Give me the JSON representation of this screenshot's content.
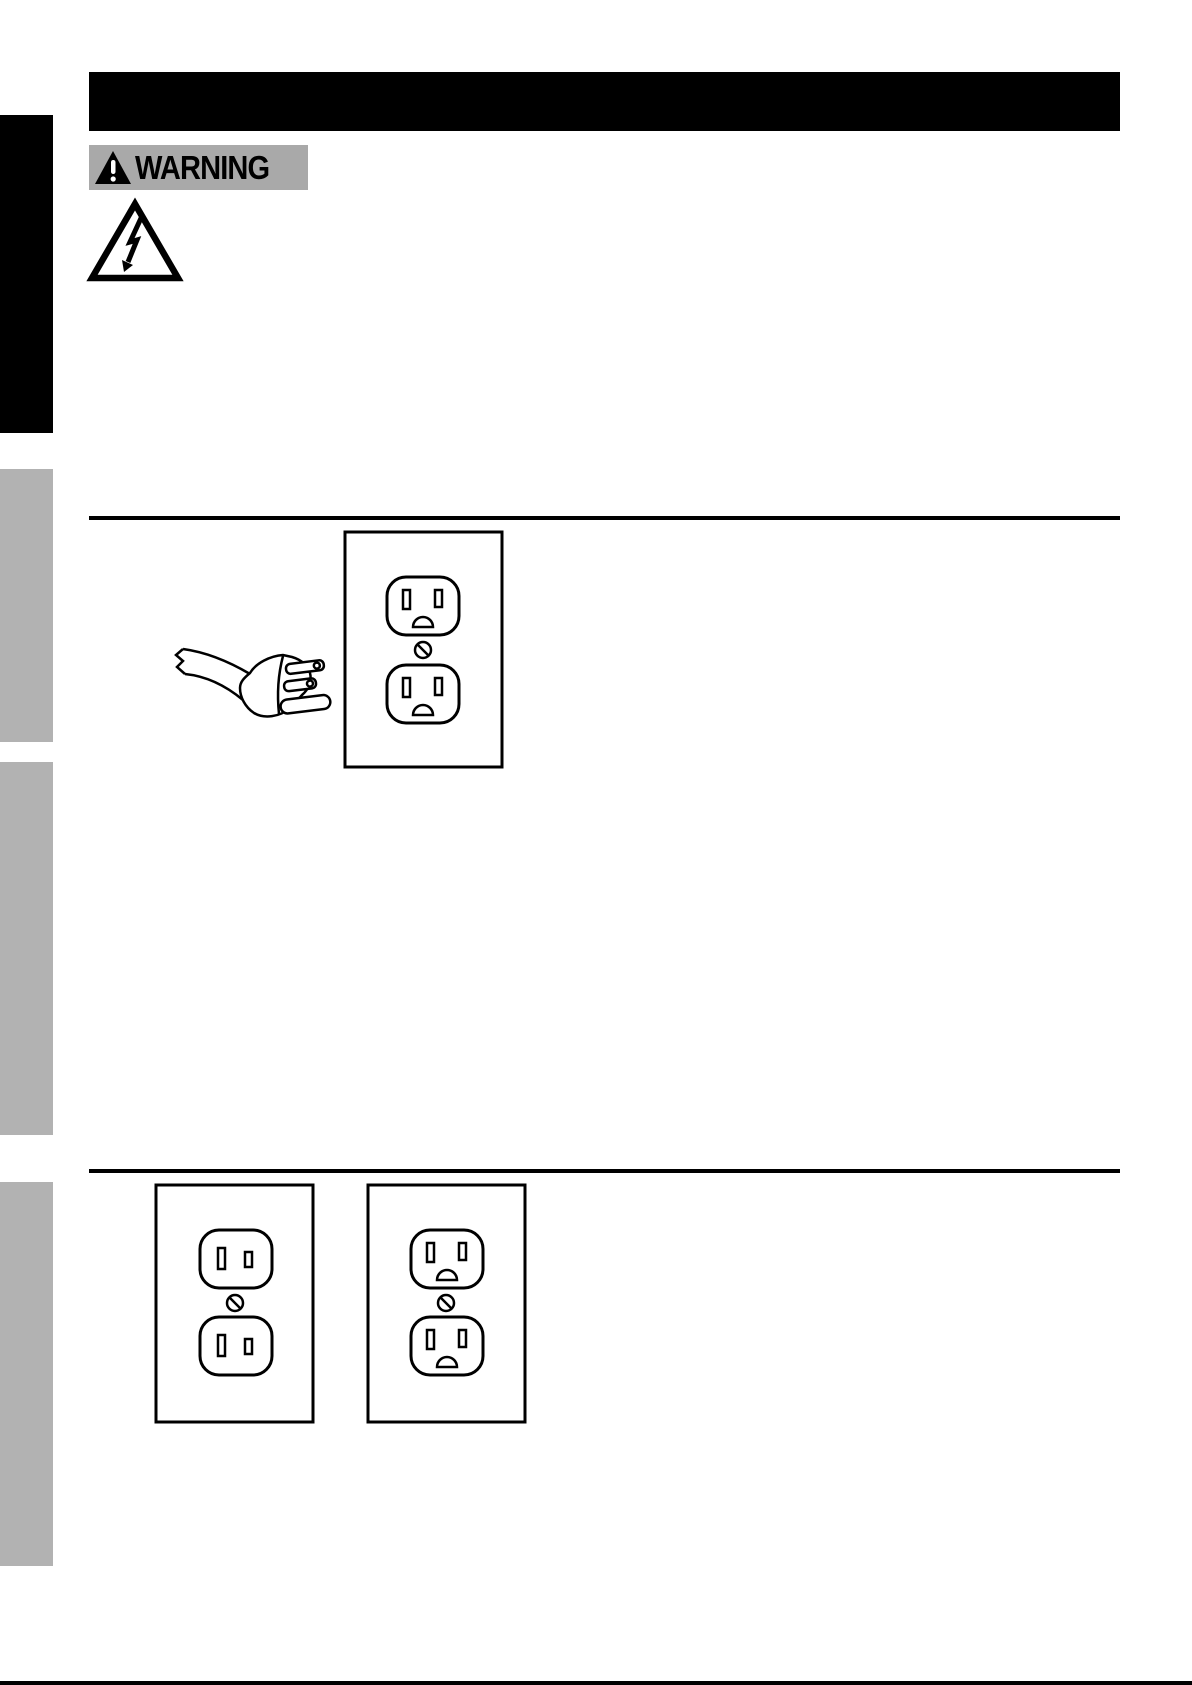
{
  "page": {
    "background": "#ffffff"
  },
  "header_bar": {
    "background": "#000000",
    "text": ""
  },
  "warning_badge": {
    "label": "WARNING",
    "background": "#a9a9a9",
    "text_color": "#000000",
    "icon": "warning-triangle-icon"
  },
  "icons": {
    "warning_triangle": "warning-triangle-icon",
    "electrical_hazard": "electrical-hazard-icon"
  },
  "sidebar_tabs": [
    {
      "color": "#000000"
    },
    {
      "color": "#b2b2b2"
    },
    {
      "color": "#b2b2b2"
    },
    {
      "color": "#b2b2b2"
    }
  ],
  "dividers": {
    "color": "#000000"
  },
  "illustrations": {
    "top": "grounded-plug-and-outlet",
    "bottom_left": "two-prong-outlet",
    "bottom_right": "three-prong-outlet"
  },
  "line_art_color": "#000000"
}
